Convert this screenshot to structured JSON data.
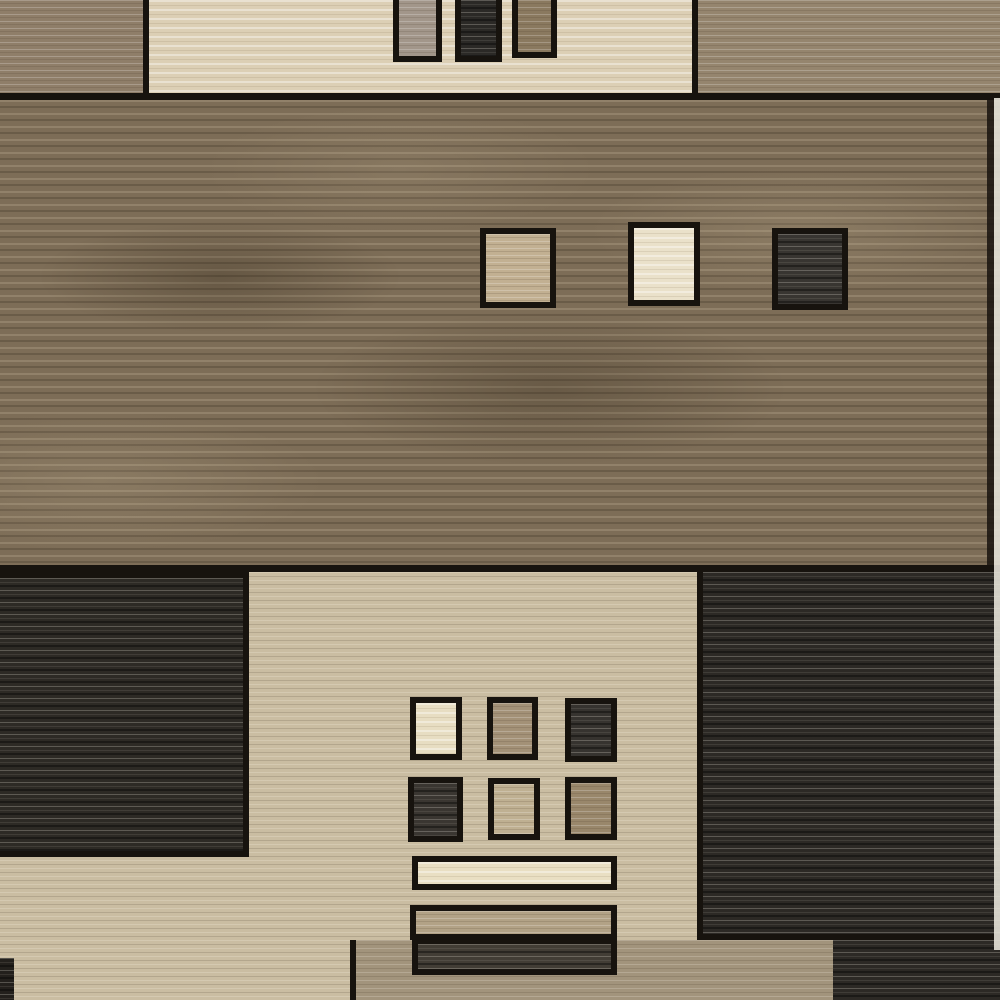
{
  "image": {
    "description": "Product photograph of a modern color-block area rug with geometric squares and bars in beige, cream, brown and charcoal tones",
    "subject": "area-rug",
    "text_content": "none"
  },
  "palette": {
    "border_black": "#17130e",
    "top_left_brown": "#8f7e69",
    "top_cream_panel": "#dccfb5",
    "top_right_brown": "#95856e",
    "top_rect_taupe": "#a2968a",
    "top_rect_dark": "#2b2926",
    "top_rect_brown": "#8a795f",
    "middle_brown_field": "#7d6d57",
    "mid_square_tan": "#c2b092",
    "mid_square_cream": "#eae1ca",
    "mid_square_dark": "#383531",
    "bottom_beige_panel": "#cabda2",
    "left_charcoal_panel": "#2d2a25",
    "right_charcoal_panel": "#2c2925",
    "grid_square_cream": "#e7ddc2",
    "grid_square_taupe": "#a39177",
    "grid_square_dark1": "#36332f",
    "grid_square_dark2": "#3a3631",
    "grid_square_light_taupe": "#bfb092",
    "grid_square_brown": "#99876b",
    "bar_cream": "#e9dfc3",
    "bar_taupe": "#b2a286",
    "bar_dark": "#423d35",
    "bottom_band_taupe": "#a2947c",
    "edge_dark_strip": "#23201c",
    "photo_edge_white": "#e6e2d8"
  }
}
